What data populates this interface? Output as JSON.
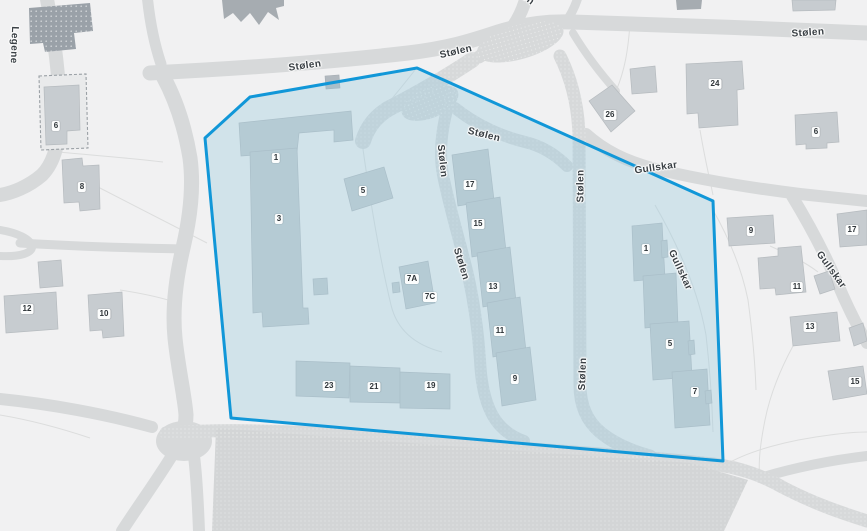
{
  "streets": {
    "legene": "Legene",
    "stolen": "Stølen",
    "gullskar": "Gullskar"
  },
  "building_numbers": {
    "inside": [
      "1",
      "3",
      "5",
      "7A",
      "7C",
      "17",
      "15",
      "13",
      "11",
      "9",
      "23",
      "21",
      "19",
      "1",
      "5",
      "7"
    ],
    "outside": [
      "6",
      "8",
      "12",
      "10",
      "26",
      "24",
      "6",
      "9",
      "11",
      "13",
      "17",
      "15"
    ]
  },
  "colors": {
    "background": "#f1f1f2",
    "road": "#d7d9da",
    "parking": "#d3d5d6",
    "building": "#c7ccd0",
    "building-dark": "#9aa1a8",
    "building-roof-dark": "#a6acb1",
    "highlight-stroke": "#1197d8",
    "highlight-fill": "rgba(150,200,220,0.35)",
    "street-label": "#3a4045",
    "badge-text": "#2e3438"
  }
}
